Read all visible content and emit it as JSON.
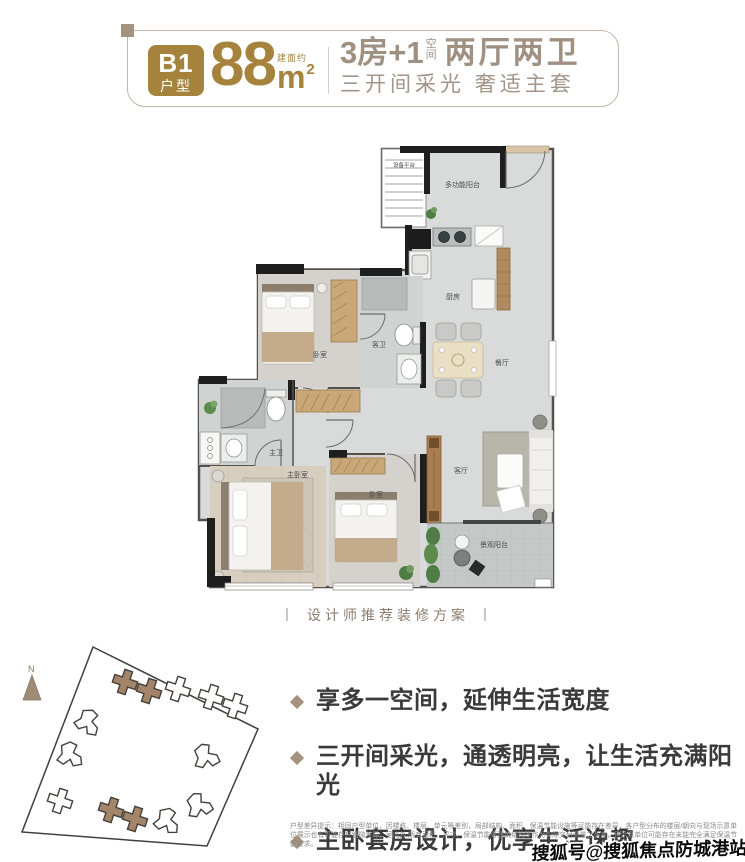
{
  "header": {
    "badge_line1": "B1",
    "badge_line2": "户型",
    "area_label": "建面约",
    "area_value": "88",
    "area_unit": "m",
    "area_exponent": "2",
    "headline_prefix": "3房+1",
    "headline_stack_top": "空",
    "headline_stack_bottom": "间",
    "headline_suffix": "两厅两卫",
    "subheadline": "三开间采光 奢适主套"
  },
  "floorplan": {
    "caption": "设计师推荐装修方案",
    "caption_bar": "丨",
    "rooms": {
      "equipment_platform": "设备平台",
      "multifunction_balcony": "多功能阳台",
      "kitchen": "厨房",
      "guest_bathroom": "客卫",
      "bedroom_top": "卧室",
      "dining_room": "餐厅",
      "master_bathroom": "主卫",
      "master_bedroom": "主卧室",
      "bedroom_right": "卧室",
      "living_room": "客厅",
      "view_balcony": "景观阳台"
    }
  },
  "siteplan": {
    "north_label": "N"
  },
  "features": {
    "items": [
      {
        "text": "享多一空间，延伸生活宽度"
      },
      {
        "text": "三开间采光，通透明亮，让生活充满阳光"
      },
      {
        "text": "主卧套房设计，优享生活逸趣"
      }
    ]
  },
  "disclaimer": {
    "line1": "户型差异提示：相同户型单位，因楼栋、楼层、单元等差别，局部结构、面积、保温节能设施等可能存在差异，各户型分布的楼层/朝向与现场示意单位展示也有可能存在细微差异，室内外",
    "line2": "所有面积、尺寸、保温节能等建筑结构不作为实际交付测量之基准，且示意单位可能存在未能完全满足保温节能要求。"
  },
  "watermark": "搜狐号@搜狐焦点防城港站",
  "colors": {
    "gold": "#a6833d",
    "taupe": "#a09082",
    "bullet_brown": "#a5917c",
    "wall_dark": "#1e1e1e"
  }
}
